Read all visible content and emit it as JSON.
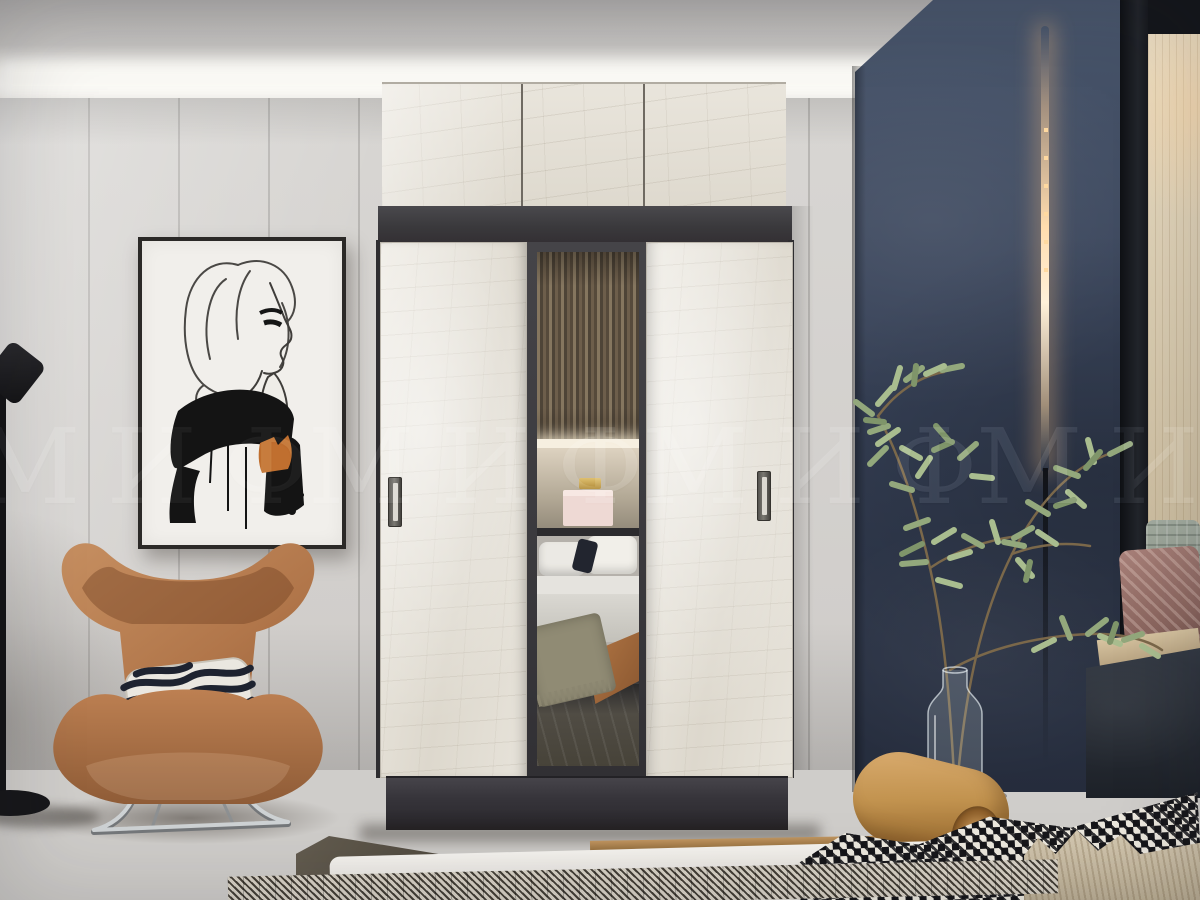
{
  "watermark": {
    "text": "МИФ",
    "instances": 4
  },
  "colors": {
    "navy_wall": "#39445a",
    "left_wall": "#d5d3d0",
    "wardrobe_door": "#e7e3da",
    "wardrobe_frame": "#3a393c",
    "chair": "#b5754a",
    "chair_shade": "#95603a",
    "floor": "#b49b82",
    "plant_leaf": "#93a87c",
    "plant_leaf_light": "#a9bd8f",
    "plant_leaf_dark": "#7f956a",
    "led_glow": "#ffdcae",
    "bolster": "#c2934f",
    "zebra_dark": "#1e2330",
    "art_ink": "#141414",
    "art_accent": "#c06f2f"
  }
}
